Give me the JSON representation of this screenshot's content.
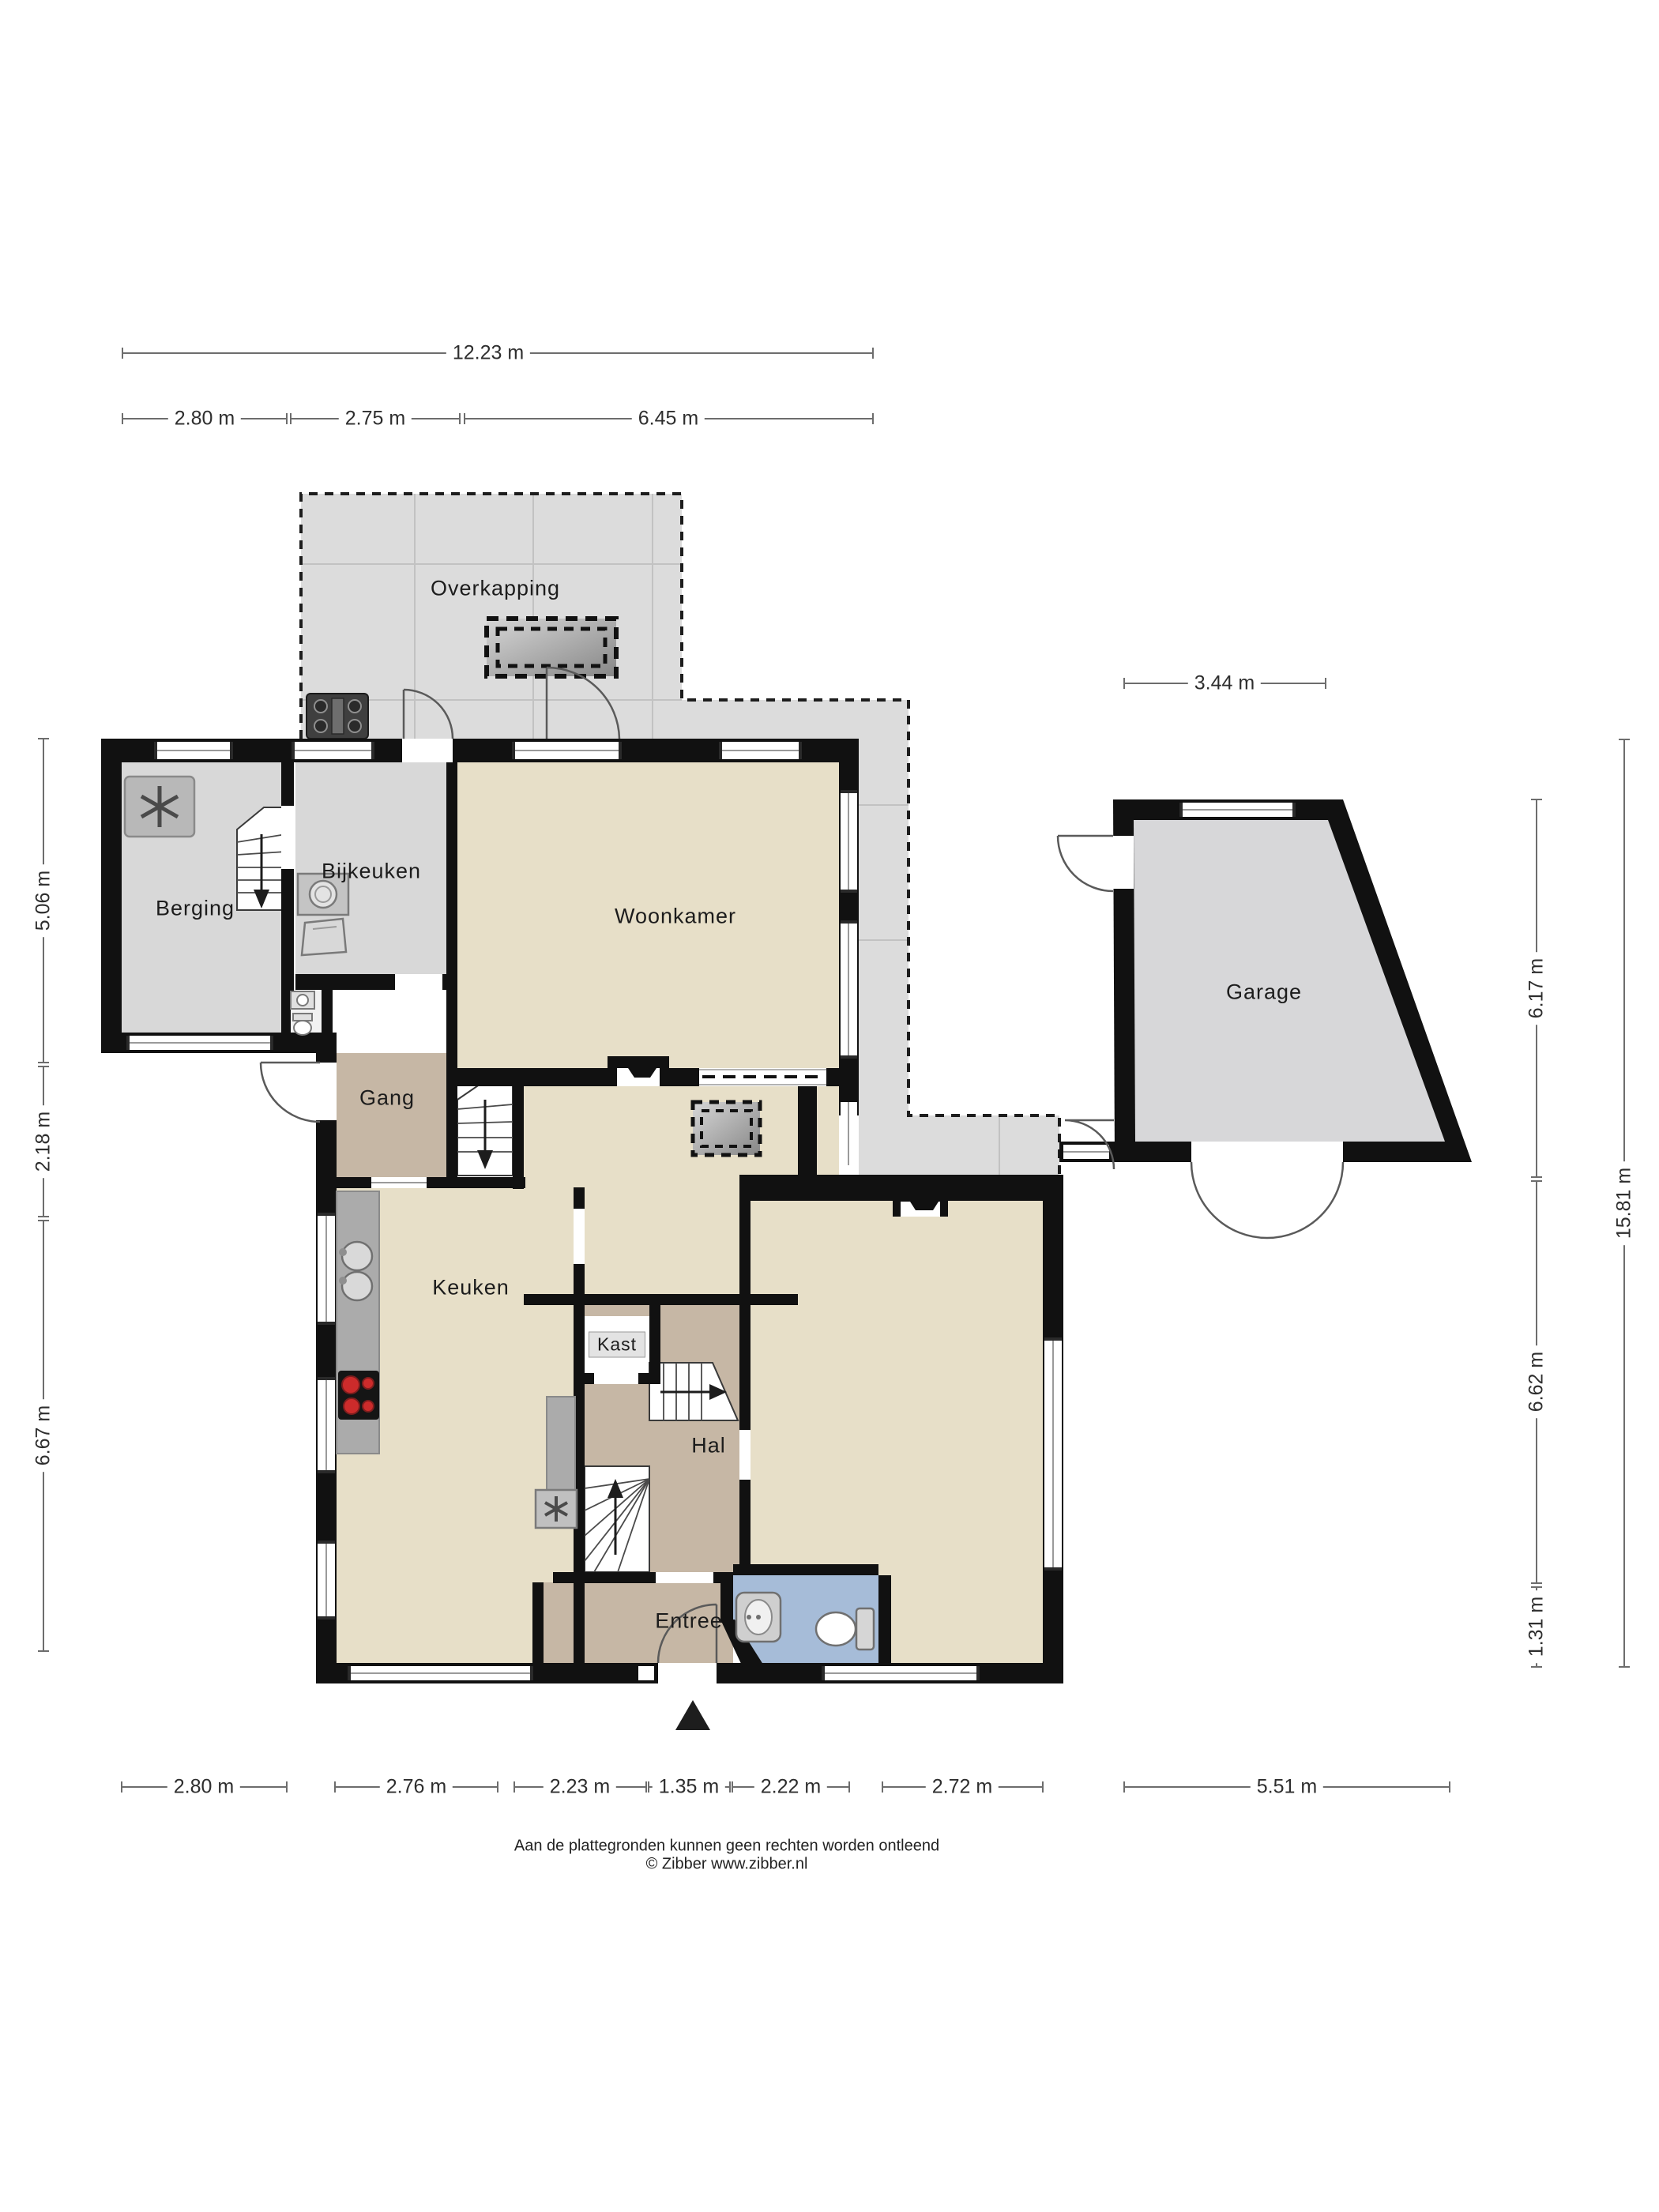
{
  "page": {
    "footer": {
      "line1": "Aan de plattegronden kunnen geen rechten worden ontleend",
      "line2": "© Zibber www.zibber.nl"
    }
  },
  "rooms": {
    "overkapping": {
      "label": "Overkapping"
    },
    "berging": {
      "label": "Berging"
    },
    "bijkeuken": {
      "label": "Bijkeuken"
    },
    "woonkamer": {
      "label": "Woonkamer"
    },
    "gang": {
      "label": "Gang"
    },
    "keuken": {
      "label": "Keuken"
    },
    "kast": {
      "label": "Kast"
    },
    "hal": {
      "label": "Hal"
    },
    "entree": {
      "label": "Entree"
    },
    "garage": {
      "label": "Garage"
    }
  },
  "dimensions": {
    "top_total": "12.23 m",
    "top_segments": [
      "2.80 m",
      "2.75 m",
      "6.45 m"
    ],
    "left_segments": [
      "5.06 m",
      "2.18 m",
      "6.67 m"
    ],
    "right_segments": [
      "6.17 m",
      "6.62 m",
      "1.31 m"
    ],
    "right_total": "15.81 m",
    "garage_width": "3.44 m",
    "bottom_segments": [
      "2.80 m",
      "2.76 m",
      "2.23 m",
      "1.35 m",
      "2.22 m",
      "2.72 m",
      "5.51 m"
    ]
  },
  "icons": {
    "heat_pump": "heat-pump-icon",
    "washer": "washing-machine-icon",
    "laundry_basket": "laundry-basket-icon",
    "bbq": "outdoor-grill-icon",
    "sink": "kitchen-sink-icon",
    "hob": "cooktop-icon",
    "fan_unit": "ventilation-unit-icon",
    "toilet": "toilet-icon",
    "washbasin": "washbasin-icon",
    "skylight": "skylight-icon",
    "entrance_marker": "entrance-arrow-icon"
  },
  "colors": {
    "wall": "#111111",
    "room_cream": "#e7dfc8",
    "room_tan": "#c6b7a5",
    "room_gray": "#d8d8d8",
    "terrace": "#dcdcdc",
    "garage": "#d7d7d9",
    "toilet_blue": "#a6bcd8",
    "accent_red": "#cc2b2b"
  }
}
